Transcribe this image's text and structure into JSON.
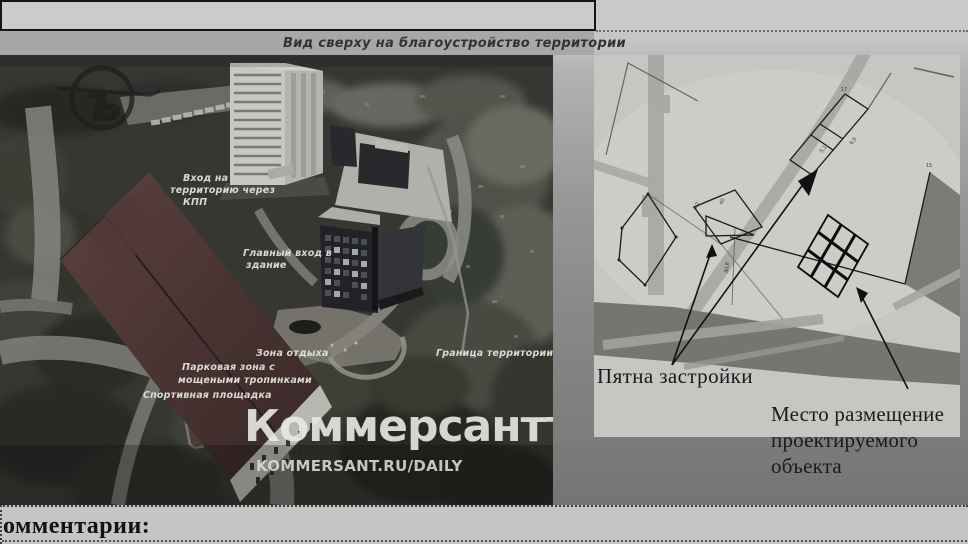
{
  "header": {
    "caption": "Вид сверху на благоустройство территории"
  },
  "photo": {
    "labels": {
      "entrance1": "Вход на",
      "entrance2": "территорию через",
      "entrance3": "КПП",
      "main_entrance1": "Главный вход в",
      "main_entrance2": "здание",
      "rest_zone": "Зона отдыха",
      "territory_border": "Граница территории",
      "park1": "Парковая зона с",
      "park2": "мощеными тропинками",
      "sports": "Спортивная площадка"
    },
    "watermark_glyph": "ъ",
    "brand_wordmark": "Коммерсантъ",
    "brand_site": "KOMMERSANT.RU/DAILY"
  },
  "plan": {
    "footprints_label": "Пятна застройки",
    "site_label1": "Место размещение",
    "site_label2": "проектируемого",
    "site_label3": "объекта",
    "dims": {
      "a": "17",
      "b": "6,5",
      "c": "5,1",
      "d": "3,2",
      "e": "40",
      "f": "30,8",
      "g": "15"
    }
  },
  "footer": {
    "comments": "омментарии:"
  },
  "colors": {
    "roof": "#553c3a",
    "ink": "#1b1b1b",
    "page_light": "#c9c9c9",
    "page_dark": "#747474"
  }
}
